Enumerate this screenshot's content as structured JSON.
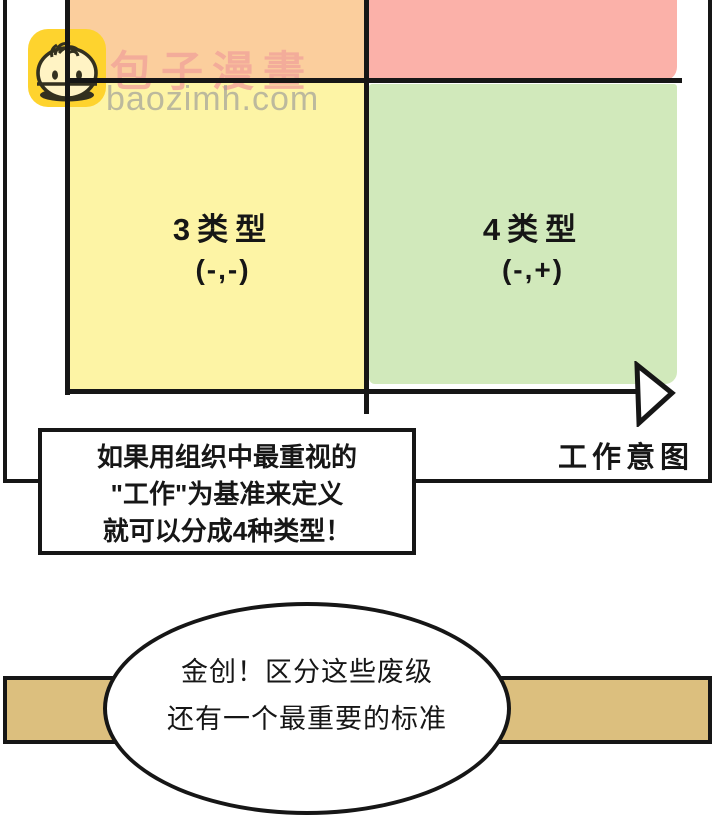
{
  "watermark": {
    "brand": "包子漫畫",
    "domain": "baozimh.com",
    "logo_color": "#fed32e",
    "brand_color": "#f2a49a",
    "domain_color": "#9a9a9a"
  },
  "diagram": {
    "type": "quadrant",
    "x_axis_label": "工作意图",
    "quadrants": [
      {
        "position": "top-left",
        "label": "",
        "sign": "",
        "color": "#fbce9d"
      },
      {
        "position": "top-right",
        "label": "",
        "sign": "",
        "color": "#fbb1a9"
      },
      {
        "position": "bottom-left",
        "label": "3类型",
        "sign": "(-,-)",
        "color": "#fdf4a5"
      },
      {
        "position": "bottom-right",
        "label": "4类型",
        "sign": "(-,+)",
        "color": "#d1e9bb"
      }
    ]
  },
  "caption_box": {
    "lines": [
      "如果用组织中最重视的",
      "\"工作\"为基准来定义",
      "就可以分成4种类型！"
    ]
  },
  "speech_bubble": {
    "lines": [
      "金创！区分这些废级",
      "还有一个最重要的标准"
    ]
  },
  "panels": {
    "bottom_fill": "#dcbf7e",
    "line_color": "#161616"
  }
}
